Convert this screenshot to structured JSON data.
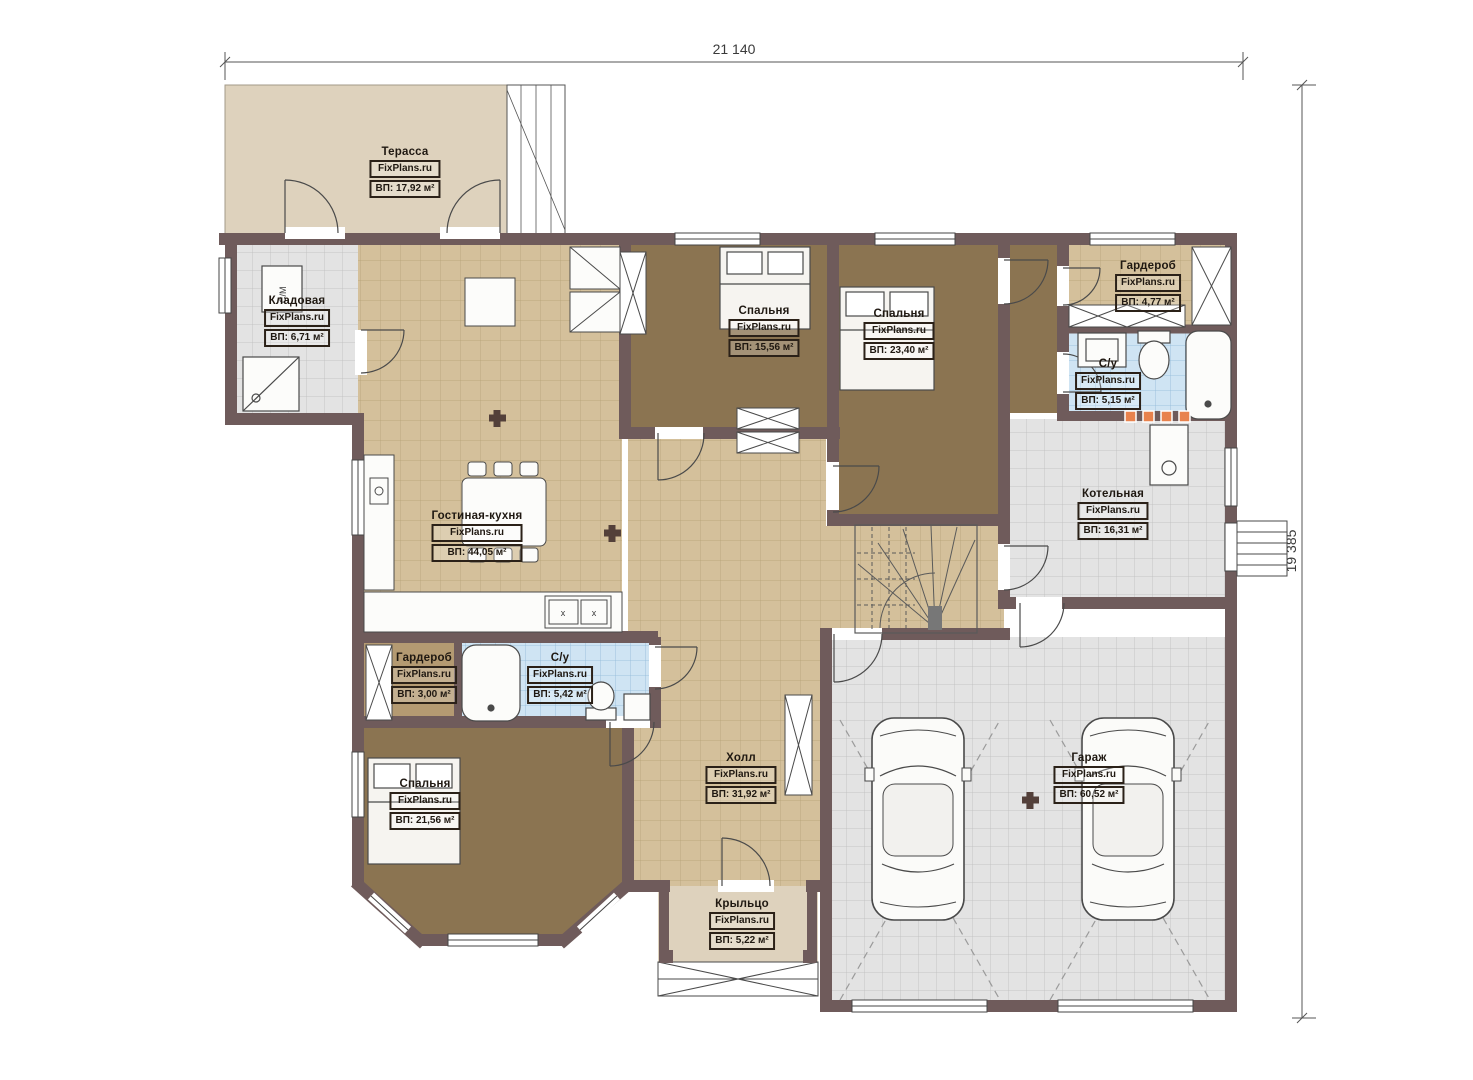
{
  "dimensions": {
    "width": "21 140",
    "height": "19 385"
  },
  "watermark": "FixPlans.ru",
  "rooms": [
    {
      "name": "Терасса",
      "brand": "FixPlans.ru",
      "area": "ВП: 17,92 м²"
    },
    {
      "name": "Кладовая",
      "brand": "FixPlans.ru",
      "area": "ВП: 6,71 м²"
    },
    {
      "name": "Гостиная-кухня",
      "brand": "FixPlans.ru",
      "area": "ВП: 44,05 м²"
    },
    {
      "name": "Спальня",
      "brand": "FixPlans.ru",
      "area": "ВП: 15,56 м²"
    },
    {
      "name": "Спальня",
      "brand": "FixPlans.ru",
      "area": "ВП: 23,40 м²"
    },
    {
      "name": "Гардероб",
      "brand": "FixPlans.ru",
      "area": "ВП: 4,77 м²"
    },
    {
      "name": "С/у",
      "brand": "FixPlans.ru",
      "area": "ВП: 5,15 м²"
    },
    {
      "name": "Котельная",
      "brand": "FixPlans.ru",
      "area": "ВП: 16,31 м²"
    },
    {
      "name": "Гардероб",
      "brand": "FixPlans.ru",
      "area": "ВП: 3,00 м²"
    },
    {
      "name": "С/у",
      "brand": "FixPlans.ru",
      "area": "ВП: 5,42 м²"
    },
    {
      "name": "Спальня",
      "brand": "FixPlans.ru",
      "area": "ВП: 21,56 м²"
    },
    {
      "name": "Холл",
      "brand": "FixPlans.ru",
      "area": "ВП: 31,92 м²"
    },
    {
      "name": "Крыльцо",
      "brand": "FixPlans.ru",
      "area": "ВП: 5,22 м²"
    },
    {
      "name": "Гараж",
      "brand": "FixPlans.ru",
      "area": "ВП: 60,52 м²"
    }
  ],
  "labels": {
    "washing_machine": "С/М",
    "stove_mark": "x"
  },
  "colors": {
    "wall": "#6f5b5b",
    "tile_tan": "#d4c09b",
    "floor_brown": "#8b7451",
    "tile_blue": "#cfe4f3",
    "tile_gray": "#e3e3e3",
    "terrace_beige": "#ded2bd",
    "accent_orange": "#e8824d"
  }
}
